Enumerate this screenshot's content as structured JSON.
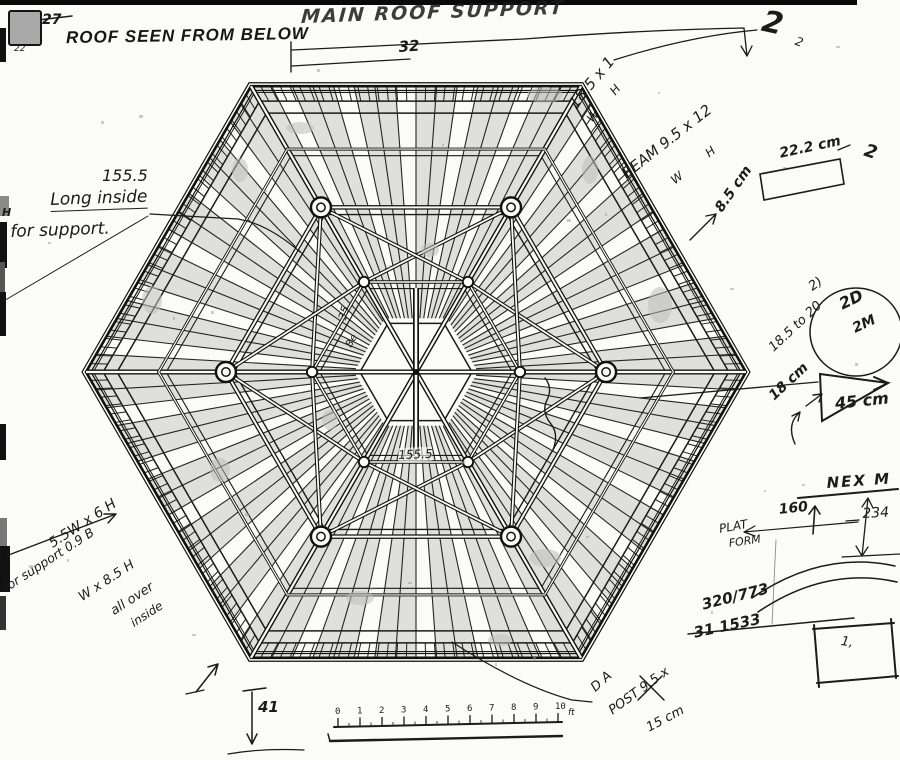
{
  "stamp": {
    "page_number": "27",
    "page_number_small": "22",
    "title": "ROOF SEEN FROM BELOW"
  },
  "header": {
    "title": "MAIN ROOF SUPPORT",
    "dimension": "32"
  },
  "marks": {
    "two_big": "2",
    "two_small": "2",
    "two_right": "2"
  },
  "dims_top_right": {
    "rafter_size": "18.5 x 1",
    "rafter_sub": "W  H",
    "beam_label": "BEAM 9.5 x 12",
    "beam_sub": "W    H",
    "cm_22": "22.2 cm",
    "cm_85": "8.5 cm"
  },
  "left_note": {
    "value": "155.5",
    "line1": "Long inside",
    "line2": "for support.",
    "margin_mark": "H"
  },
  "right_note": {
    "range": "18.5 to 20",
    "cm_18": "18 cm",
    "cm_45": "45 cm",
    "circle_top": "2)",
    "circle_a": "2D",
    "circle_b": "2M"
  },
  "nex_sketch": {
    "title": "NEX M",
    "v160": "160",
    "v234": "234",
    "plat": "PLAT",
    "form": "FORM"
  },
  "calc": {
    "top": "320/773",
    "bottom": "31 1533",
    "square_mark": "1,"
  },
  "bottom": {
    "dim_41": "41",
    "post_line1": "D A",
    "post_line2": "POST 9.5 x",
    "post_line3": "15 cm"
  },
  "bottom_left_note": {
    "line1": "5.5W x 6 H",
    "line2": "for support 0.9 B",
    "line3": "W x 8.5 H",
    "line4": "all over",
    "line5": "inside"
  },
  "inner_labels": {
    "beam_155": "155.5",
    "v35": "35",
    "squiggle": "Be"
  },
  "scale_bar": {
    "ticks": [
      "0",
      "1",
      "2",
      "3",
      "4",
      "5",
      "6",
      "7",
      "8",
      "9",
      "10"
    ],
    "unit": "ft"
  },
  "colors": {
    "ink": "#1a1a1a",
    "shade": "#c9c9c9",
    "scan_black": "#0a0a0a",
    "paper": "#fbfbf9"
  }
}
